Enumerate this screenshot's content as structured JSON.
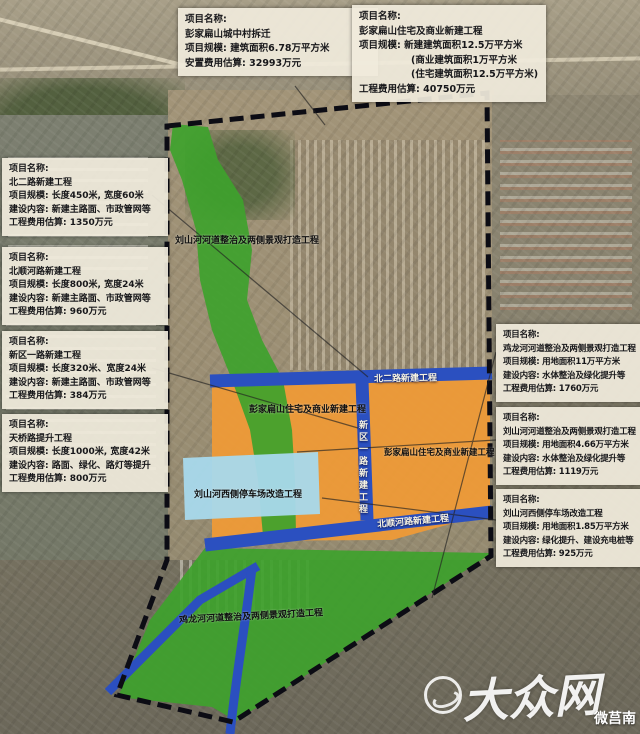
{
  "colors": {
    "green_area": "#3ea22c",
    "orange_area": "#ef9a36",
    "blue_road": "#2b50c0",
    "cyan_parking": "#a8d9ec",
    "boundary": "#0c0c14",
    "box_bg": "#f0ebdb"
  },
  "info_boxes": [
    {
      "id": "pengjiabianshan-demolition",
      "lines": [
        "项目名称:",
        "彭家扁山城中村拆迁",
        "项目规模: 建筑面积6.78万平方米",
        "安置费用估算: 32993万元"
      ]
    },
    {
      "id": "pengjiabianshan-newbuild",
      "lines": [
        "项目名称:",
        "彭家扁山住宅及商业新建工程",
        "项目规模: 新建建筑面积12.5万平方米",
        "(商业建筑面积1万平方米",
        "(住宅建筑面积12.5万平方米)",
        "工程费用估算: 40750万元"
      ]
    },
    {
      "id": "beierlu-road",
      "lines": [
        "项目名称:",
        "北二路新建工程",
        "项目规模: 长度450米, 宽度60米",
        "建设内容: 新建主路面、市政管网等",
        "工程费用估算: 1350万元"
      ]
    },
    {
      "id": "beishunhelu-road",
      "lines": [
        "项目名称:",
        "北顺河路新建工程",
        "项目规模: 长度800米, 宽度24米",
        "建设内容: 新建主路面、市政管网等",
        "工程费用估算: 960万元"
      ]
    },
    {
      "id": "xinquyilu-road",
      "lines": [
        "项目名称:",
        "新区一路新建工程",
        "项目规模: 长度320米、宽度24米",
        "建设内容: 新建主路面、市政管网等",
        "工程费用估算: 384万元"
      ]
    },
    {
      "id": "tianqiaolu-upgrade",
      "lines": [
        "项目名称:",
        "天桥路提升工程",
        "项目规模: 长度1000米, 宽度42米",
        "建设内容: 路面、绿化、路灯等提升",
        "工程费用估算: 800万元"
      ]
    },
    {
      "id": "jilonghe-river",
      "lines": [
        "项目名称:",
        "鸡龙河河道整治及两侧景观打造工程",
        "项目规模: 用地面积11万平方米",
        "建设内容: 水体整治及绿化提升等",
        "工程费用估算: 1760万元"
      ]
    },
    {
      "id": "liushanhe-river",
      "lines": [
        "项目名称:",
        "刘山河河道整治及两侧景观打造工程",
        "项目规模: 用地面积4.66万平方米",
        "建设内容: 水体整治及绿化提升等",
        "工程费用估算: 1119万元"
      ]
    },
    {
      "id": "liushanhe-parking",
      "lines": [
        "项目名称:",
        "刘山河西侧停车场改造工程",
        "项目规模: 用地面积1.85万平方米",
        "建设内容: 绿化提升、建设充电桩等",
        "工程费用估算: 925万元"
      ]
    }
  ],
  "map_labels": [
    {
      "text": "刘山河河道整治及两侧景观打造工程"
    },
    {
      "text": "北二路新建工程"
    },
    {
      "text": "彭家扁山住宅及商业新建工程"
    },
    {
      "text": "彭家扁山住宅及商业新建工程"
    },
    {
      "text": "新区一路新建工程"
    },
    {
      "text": "刘山河西侧停车场改造工程"
    },
    {
      "text": "北顺河路新建工程"
    },
    {
      "text": "鸡龙河河道整治及两侧景观打造工程"
    }
  ],
  "watermark": {
    "logo_text": "大众网",
    "account": "微莒南"
  }
}
